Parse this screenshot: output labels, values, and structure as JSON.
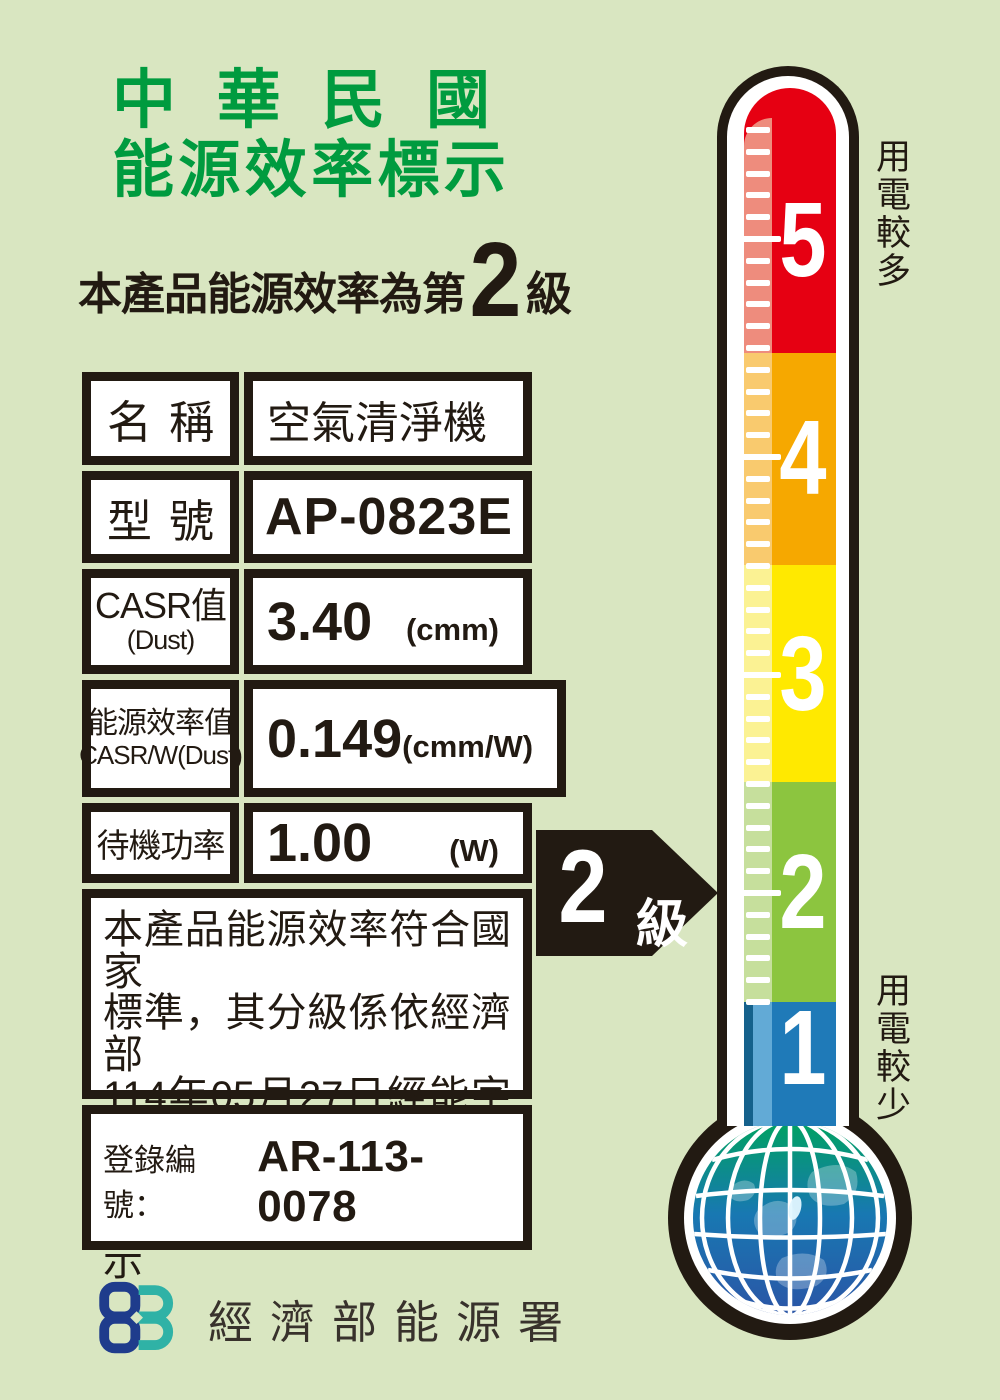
{
  "colors": {
    "background": "#D9E6C1",
    "ink": "#221A12",
    "title_green": "#009B3F",
    "logo_blue": "#1F3C8C",
    "logo_teal": "#2FB2A6"
  },
  "header": {
    "title_line1": "中華民國",
    "title_line2": "能源效率標示",
    "subtitle_prefix": "本產品能源效率為第",
    "subtitle_grade": "2",
    "subtitle_suffix": "級"
  },
  "table": {
    "rows": [
      {
        "label": "名稱",
        "value": "空氣清淨機"
      },
      {
        "label": "型號",
        "value": "AP-0823E"
      },
      {
        "label_main": "CASR值",
        "label_sub": "(Dust)",
        "value": "3.40",
        "unit": "(cmm)"
      },
      {
        "label_main": "能源效率值",
        "label_sub": "CASR/W(Dust)",
        "value": "0.149",
        "unit": "(cmm/W)"
      },
      {
        "label": "待機功率",
        "value": "1.00",
        "unit": "(W)"
      }
    ],
    "statement_lines": [
      "本產品能源效率符合國家",
      "標準，其分級係依經濟部",
      "114年05月27日經能字第",
      "11458002290號公告之",
      "能源效率分級標示表標示"
    ],
    "registration_label": "登錄編號：",
    "registration_number": "AR-113-0078"
  },
  "footer": {
    "agency": "經濟部能源署"
  },
  "thermometer": {
    "scale_top_label": "用電較多",
    "scale_bottom_label": "用電較少",
    "arrow_grade": "2",
    "arrow_suffix": "級",
    "levels": [
      {
        "value": "5",
        "color": "#E60012",
        "strip": "#EE8C7D"
      },
      {
        "value": "4",
        "color": "#F6A800",
        "strip": "#F9CA6E"
      },
      {
        "value": "3",
        "color": "#FFE900",
        "strip": "#FBF293"
      },
      {
        "value": "2",
        "color": "#8CC53F",
        "strip": "#C6DF9C"
      },
      {
        "value": "1",
        "color": "#1F7AB8",
        "strip": "#62AAD6",
        "edge": "#15618C"
      }
    ]
  }
}
